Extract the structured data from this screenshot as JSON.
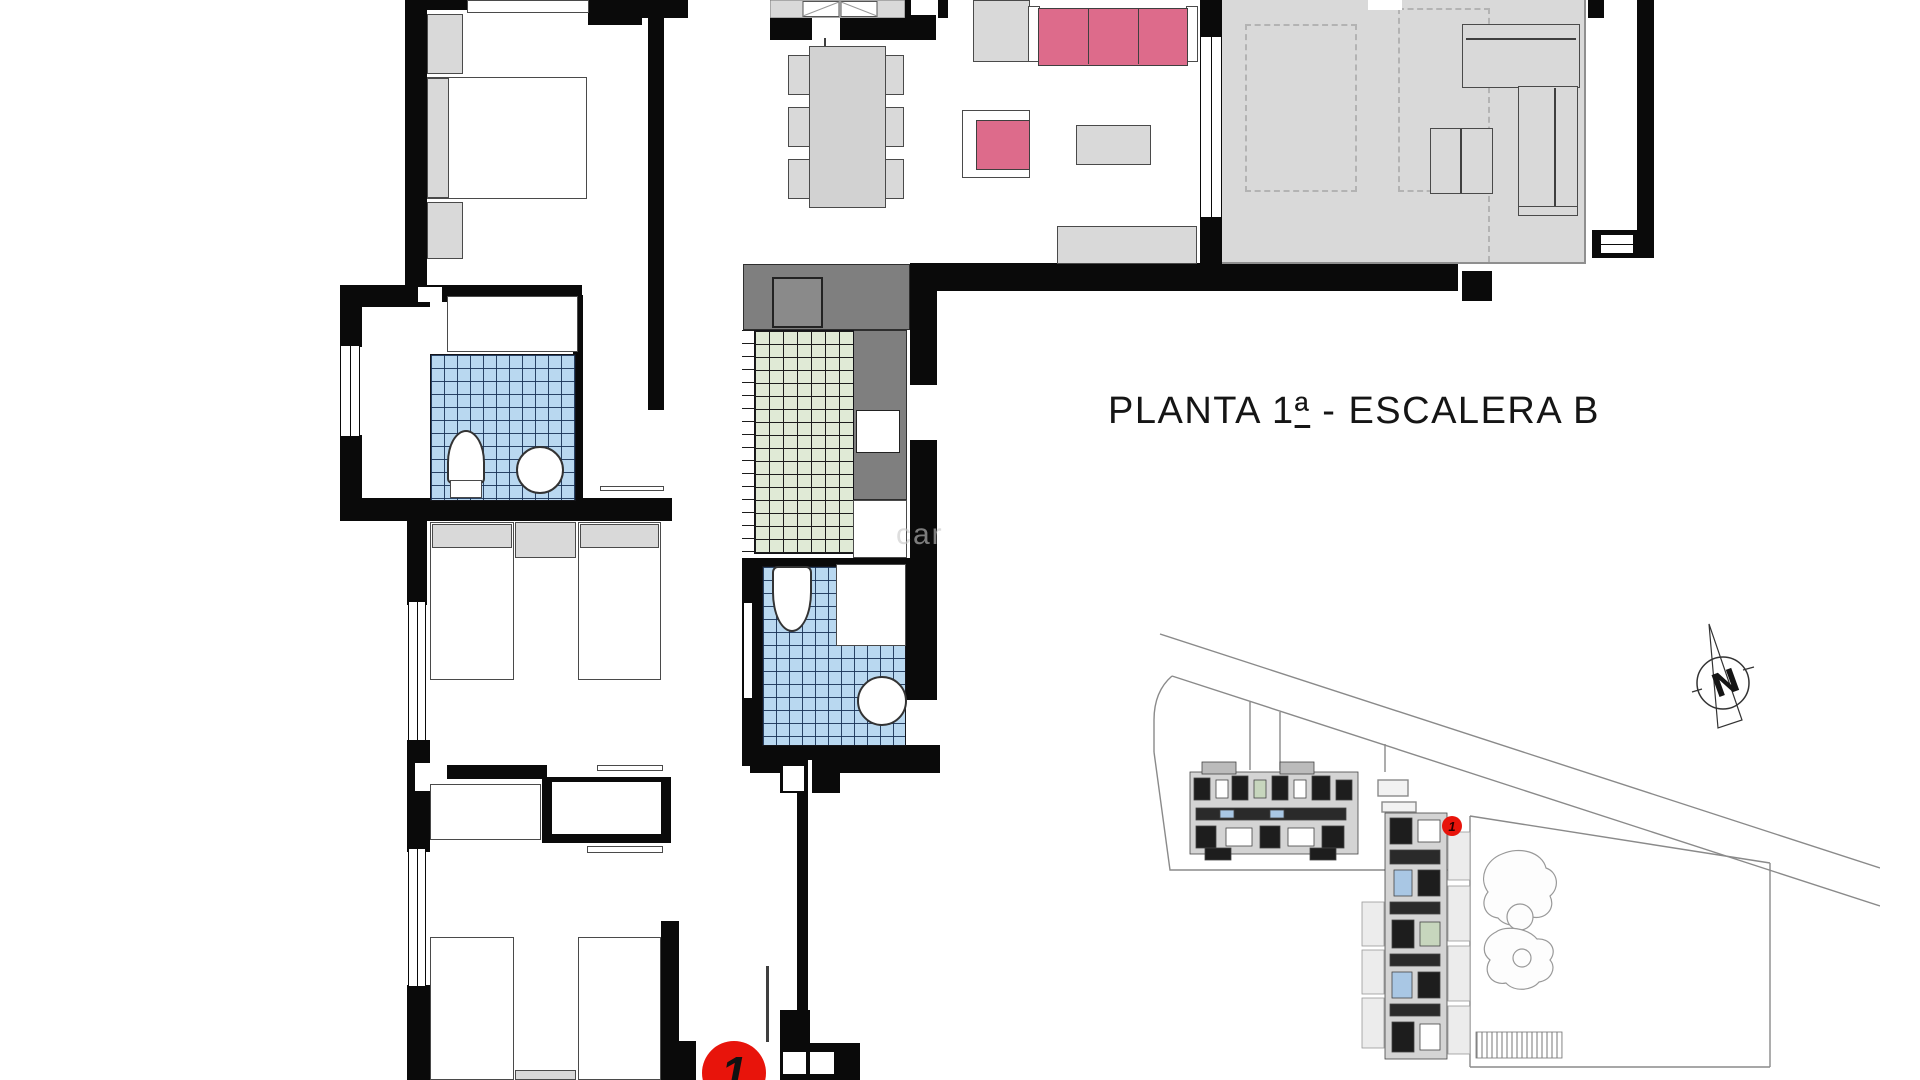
{
  "title": {
    "prefix": "PLANTA 1",
    "ordinal": "ª",
    "suffix": " - ESCALERA B"
  },
  "badges": {
    "floor_plan_unit": "1",
    "site_plan_unit": "1",
    "color": "#e8140b"
  },
  "watermark": {
    "text": "car"
  },
  "palette": {
    "wall": "#0a0a0a",
    "furniture_gray": "#d9d9d9",
    "counter_gray": "#7f7f7f",
    "terrace_gray": "#d9d9d9",
    "sofa_pink": "#dd6b8b",
    "tile_blue": "#b9d8f0",
    "tile_green": "#e0ead6",
    "badge_red": "#e8140b",
    "siteplan_line": "#8a8a8a"
  }
}
